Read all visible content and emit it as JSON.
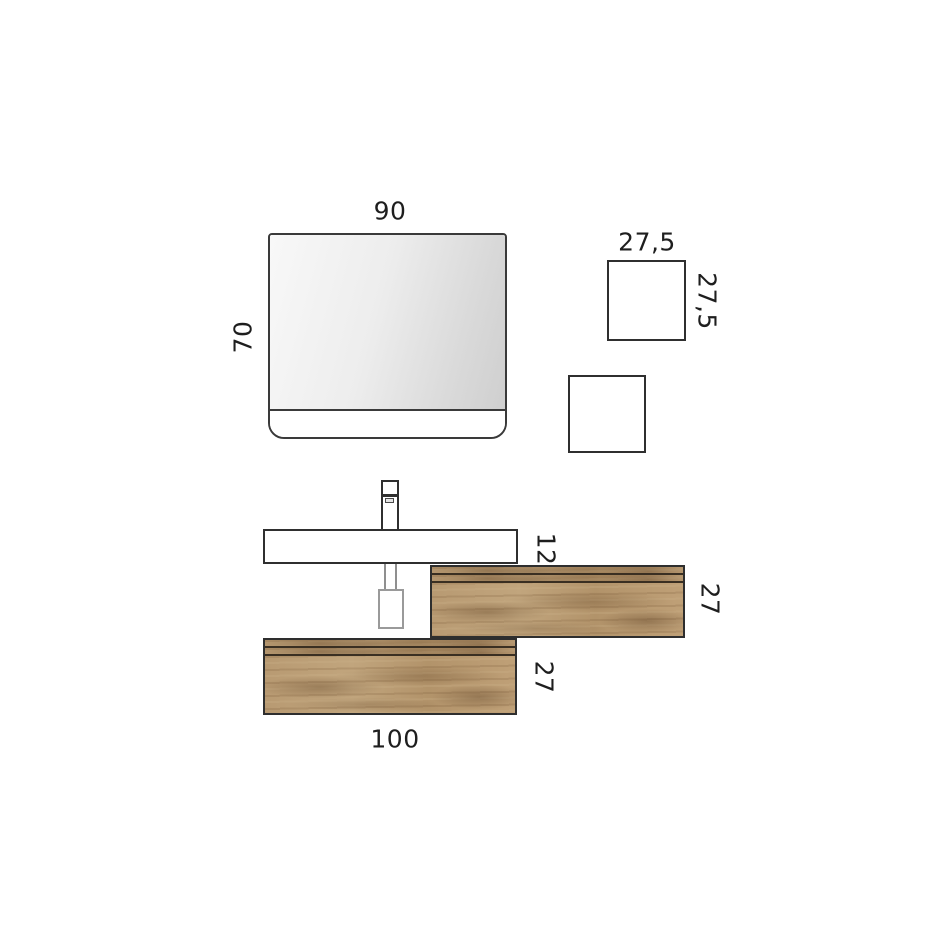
{
  "diagram": {
    "title": "bathroom-vanity-dimension-drawing",
    "mirror": {
      "width_label": "90",
      "height_label": "70"
    },
    "wall_box": {
      "width_label": "27,5",
      "height_label": "27,5"
    },
    "basin": {
      "thickness_label": "12"
    },
    "upper_cabinet": {
      "height_label": "27"
    },
    "lower_cabinet": {
      "height_label": "27",
      "width_label": "100"
    }
  },
  "colors": {
    "background": "#ffffff",
    "outline": "#2f2f2f",
    "soft_outline": "#9a9a9a",
    "label_text": "#1e1e1e",
    "wood_base": "#b99a72",
    "wood_groove": "#3a2f22",
    "mirror_gradient_start": "#f8f8f8",
    "mirror_gradient_end": "#cfcfcf"
  }
}
